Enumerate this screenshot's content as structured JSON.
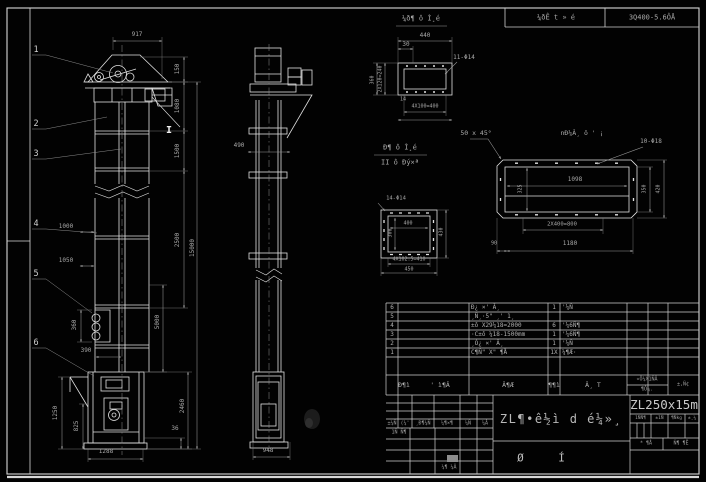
{
  "top_header": {
    "detail_title": "¼ð¶ ô Ì¸é",
    "cell1": "¼ðÊ t » é",
    "cell2": "3Q400-5.6ÔÅ"
  },
  "annotations": [
    {
      "id": "note-11-phi14",
      "t": "11-Φ14",
      "x": 464,
      "y": 58,
      "s": 6
    },
    {
      "id": "note-chamfer",
      "t": "50 x 45°",
      "x": 476,
      "y": 133,
      "s": 6.5
    },
    {
      "id": "note-10-phi18",
      "t": "10-Φ18",
      "x": 651,
      "y": 142,
      "s": 6
    },
    {
      "id": "note-14-phi14",
      "t": "14-Φ14",
      "x": 396,
      "y": 199,
      "s": 5.5
    },
    {
      "id": "flange-label",
      "t": "nÐ¼Â¸ ô ' ¡",
      "x": 582,
      "y": 133,
      "s": 6.5
    },
    {
      "id": "section-label-line1",
      "t": "Ð¶ ô Ì¸é",
      "x": 400,
      "y": 148,
      "s": 7
    },
    {
      "id": "section-label-line2",
      "t": "II ô Ðý×ª",
      "x": 400,
      "y": 163,
      "s": 7
    },
    {
      "id": "section-mark",
      "t": "I",
      "x": 169,
      "y": 131,
      "s": 10,
      "b": 1
    }
  ],
  "callouts": [
    {
      "n": "1",
      "x": 36,
      "y": 50
    },
    {
      "n": "2",
      "x": 36,
      "y": 124
    },
    {
      "n": "3",
      "x": 36,
      "y": 154
    },
    {
      "n": "4",
      "x": 36,
      "y": 224
    },
    {
      "n": "5",
      "x": 36,
      "y": 274
    },
    {
      "n": "6",
      "x": 36,
      "y": 343
    }
  ],
  "dimensions": [
    {
      "id": "d917",
      "t": "917",
      "x": 137,
      "y": 35
    },
    {
      "id": "d150",
      "t": "150",
      "x": 178,
      "y": 69,
      "r": 1
    },
    {
      "id": "d1080",
      "t": "1080",
      "x": 178,
      "y": 106,
      "r": 1
    },
    {
      "id": "d1500",
      "t": "1500",
      "x": 178,
      "y": 151,
      "r": 1
    },
    {
      "id": "d2500",
      "t": "2500",
      "x": 178,
      "y": 240,
      "r": 1
    },
    {
      "id": "d15000",
      "t": "15000",
      "x": 193,
      "y": 248,
      "r": 1
    },
    {
      "id": "d5000",
      "t": "5000",
      "x": 158,
      "y": 322,
      "r": 1
    },
    {
      "id": "d1000",
      "t": "1000",
      "x": 66,
      "y": 227
    },
    {
      "id": "d1050",
      "t": "1050",
      "x": 66,
      "y": 261
    },
    {
      "id": "d360",
      "t": "360",
      "x": 75,
      "y": 325,
      "r": 1
    },
    {
      "id": "d390",
      "t": "390",
      "x": 86,
      "y": 351
    },
    {
      "id": "d1250",
      "t": "1250",
      "x": 56,
      "y": 413,
      "r": 1
    },
    {
      "id": "d825",
      "t": "825",
      "x": 77,
      "y": 426,
      "r": 1
    },
    {
      "id": "d2460",
      "t": "2460",
      "x": 183,
      "y": 406,
      "r": 1
    },
    {
      "id": "d36",
      "t": "36",
      "x": 175,
      "y": 429
    },
    {
      "id": "d1288",
      "t": "1288",
      "x": 106,
      "y": 452
    },
    {
      "id": "d490",
      "t": "490",
      "x": 239,
      "y": 146
    },
    {
      "id": "d948",
      "t": "948",
      "x": 268,
      "y": 451
    },
    {
      "id": "d440",
      "t": "440",
      "x": 425,
      "y": 36
    },
    {
      "id": "d30",
      "t": "30",
      "x": 406,
      "y": 45
    },
    {
      "id": "d240",
      "t": "2X120=240",
      "x": 381,
      "y": 79,
      "r": 1,
      "s": 5
    },
    {
      "id": "d360a",
      "t": "360",
      "x": 373,
      "y": 80,
      "r": 1,
      "s": 5
    },
    {
      "id": "d14",
      "t": "14",
      "x": 403,
      "y": 100,
      "s": 5
    },
    {
      "id": "d400a",
      "t": "4X100=400",
      "x": 425,
      "y": 107,
      "s": 5
    },
    {
      "id": "d400b",
      "t": "400",
      "x": 408,
      "y": 224,
      "s": 5
    },
    {
      "id": "d300",
      "t": "300",
      "x": 391,
      "y": 233,
      "r": 1,
      "s": 5
    },
    {
      "id": "d430a",
      "t": "430",
      "x": 442,
      "y": 232,
      "r": 1,
      "s": 5
    },
    {
      "id": "d410",
      "t": "4X102.5=410",
      "x": 409,
      "y": 260,
      "s": 5
    },
    {
      "id": "d450",
      "t": "450",
      "x": 409,
      "y": 270,
      "s": 5
    },
    {
      "id": "d1098",
      "t": "1098",
      "x": 575,
      "y": 180
    },
    {
      "id": "d325",
      "t": "325",
      "x": 521,
      "y": 189,
      "r": 1,
      "s": 5
    },
    {
      "id": "d350",
      "t": "350",
      "x": 645,
      "y": 189,
      "r": 1,
      "s": 5
    },
    {
      "id": "d420",
      "t": "420",
      "x": 659,
      "y": 189,
      "r": 1,
      "s": 5
    },
    {
      "id": "d800",
      "t": "2X400=800",
      "x": 562,
      "y": 225,
      "s": 5.5
    },
    {
      "id": "d90",
      "t": "90",
      "x": 494,
      "y": 244,
      "s": 5
    },
    {
      "id": "d1180",
      "t": "1180",
      "x": 570,
      "y": 244
    }
  ],
  "bom": {
    "header": {
      "no": "Ð¶ì",
      "code": "' ì¶Â",
      "name": "Â¶Æ",
      "qty": "¶¶ì",
      "mat": "Â¸ T",
      "weight_top": "«Ô¼X1ÑÂ",
      "weight_bottom": "¶Ô¼.",
      "remark": "±,Ñ¢"
    },
    "rows": [
      {
        "no": "6",
        "name": "Ð¿ ×' Â¸",
        "qty": "1",
        "mat": "'¼Ñ"
      },
      {
        "no": "5",
        "name": "¸Ñ¸·5\" ¸' 1¸",
        "qty": "",
        "mat": ""
      },
      {
        "no": "4",
        "name": "±ô X29¼18=2000",
        "qty": "6",
        "mat": "'¼6Ñ¶"
      },
      {
        "no": "3",
        "name": "·C±ô ¼18-1500mm",
        "qty": "1",
        "mat": "'¼6Ñ¶"
      },
      {
        "no": "2",
        "name": "¸Ò¿ ×' Â¸",
        "qty": "1",
        "mat": "'¼Ñ"
      },
      {
        "no": "1",
        "name": "C¶Ñ\" X\" ¶Å",
        "qty": "1X",
        "mat": "¼¶Æ·"
      }
    ]
  },
  "titleblock": {
    "product": "ZL¶•ê½ì d é¼»¸",
    "model": "ZL250x15m",
    "drawing_type": "Ø Í",
    "rev_labels": [
      "±¼Ñ",
      "(¼'",
      "¸Ð¶¼Ñ",
      "¼¶×¶",
      "¼Ñ",
      "¼Â"
    ],
    "sig_label": "1Ñ Ñ¶",
    "date_label": "¼¶ ¼Â",
    "stage_labels": [
      "1ÑÑ¶",
      "±1Ñ",
      "¶Ñkg",
      "±¸¼"
    ],
    "sheet_left": "* ¶Å",
    "sheet_right": "Ñ¶ ¶Ë"
  }
}
